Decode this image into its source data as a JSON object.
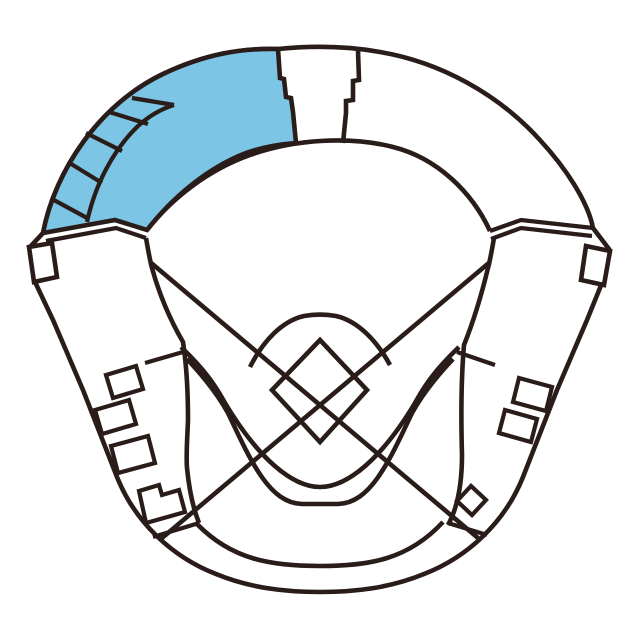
{
  "map": {
    "type": "baseball-stadium-seating-map",
    "highlighted_section": "left-outfield-upper-stand",
    "sections": {
      "upper_deck_left": "highlighted",
      "upper_deck_right": "plain",
      "scoreboard_notch": "top-center",
      "band_cell_count": 5
    }
  },
  "colors": {
    "background": "#ffffff",
    "line": "#2a1d19",
    "highlight": "#7cc5e5"
  }
}
